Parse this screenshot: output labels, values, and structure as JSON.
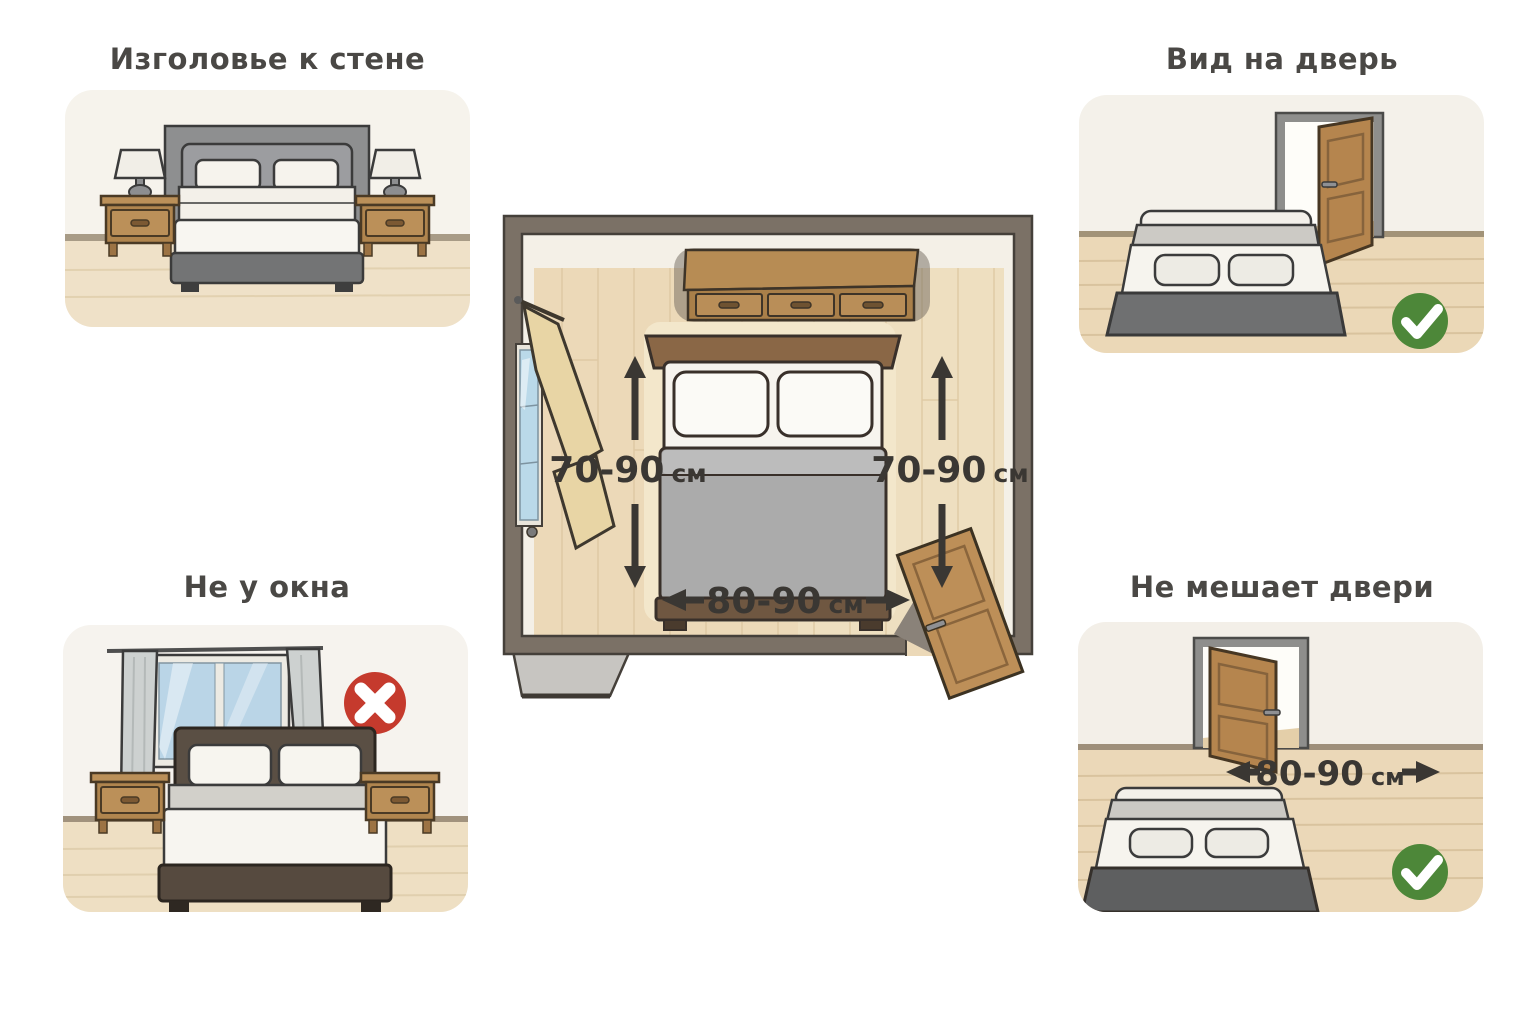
{
  "infographic": {
    "panels": {
      "headboard_to_wall": {
        "title": "Изголовье к стене"
      },
      "view_of_door": {
        "title": "Вид на дверь",
        "status_icon": "check-green"
      },
      "not_by_window": {
        "title": "Не у окна",
        "status_icon": "cross-red"
      },
      "not_blocking_door": {
        "title": "Не мешает двери",
        "status_icon": "check-green",
        "clearance": {
          "value": "80-90",
          "unit": "см"
        }
      }
    },
    "floorplan": {
      "left_clearance": {
        "value": "70-90",
        "unit": "см"
      },
      "right_clearance": {
        "value": "70-90",
        "unit": "см"
      },
      "foot_clearance": {
        "value": "80-90",
        "unit": "см"
      }
    },
    "colors": {
      "approve_green": "#4d8739",
      "reject_red": "#c53a2d",
      "text_dark": "#3a3733"
    }
  }
}
